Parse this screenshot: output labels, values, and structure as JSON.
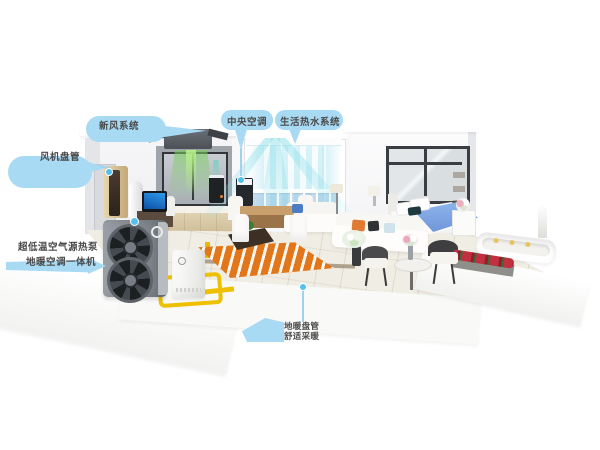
{
  "labels": {
    "fresh_air": {
      "text": "新风系统"
    },
    "central_ac": {
      "text": "中央空调"
    },
    "hot_water": {
      "text": "生活热水系统"
    },
    "fan_coil": {
      "text": "风机盘管"
    },
    "heat_pump": {
      "line1": "超低温空气源热泵",
      "line2": "地暖空调一体机"
    },
    "floor_heating": {
      "line1": "地暖盘管",
      "line2": "舒适采暖"
    }
  },
  "colors": {
    "background": "#FFFFFF",
    "label_bubble_blue": "#A8DAF3",
    "label_text_gray": "#4A4A4A",
    "connector_blue": "#54C0EE",
    "pipe_yellow": "#EFC000",
    "floor_heating_orange": "#E2761B",
    "fresh_air_green": "#78CD5A",
    "ac_airflow_teal": "#82DCE6",
    "outdoor_unit_gray": "#7E848B",
    "indoor_cabinet_gold": "#C9AE7E",
    "bed_blanket_blue": "#7FA8E6",
    "flower_red": "#C13040"
  }
}
